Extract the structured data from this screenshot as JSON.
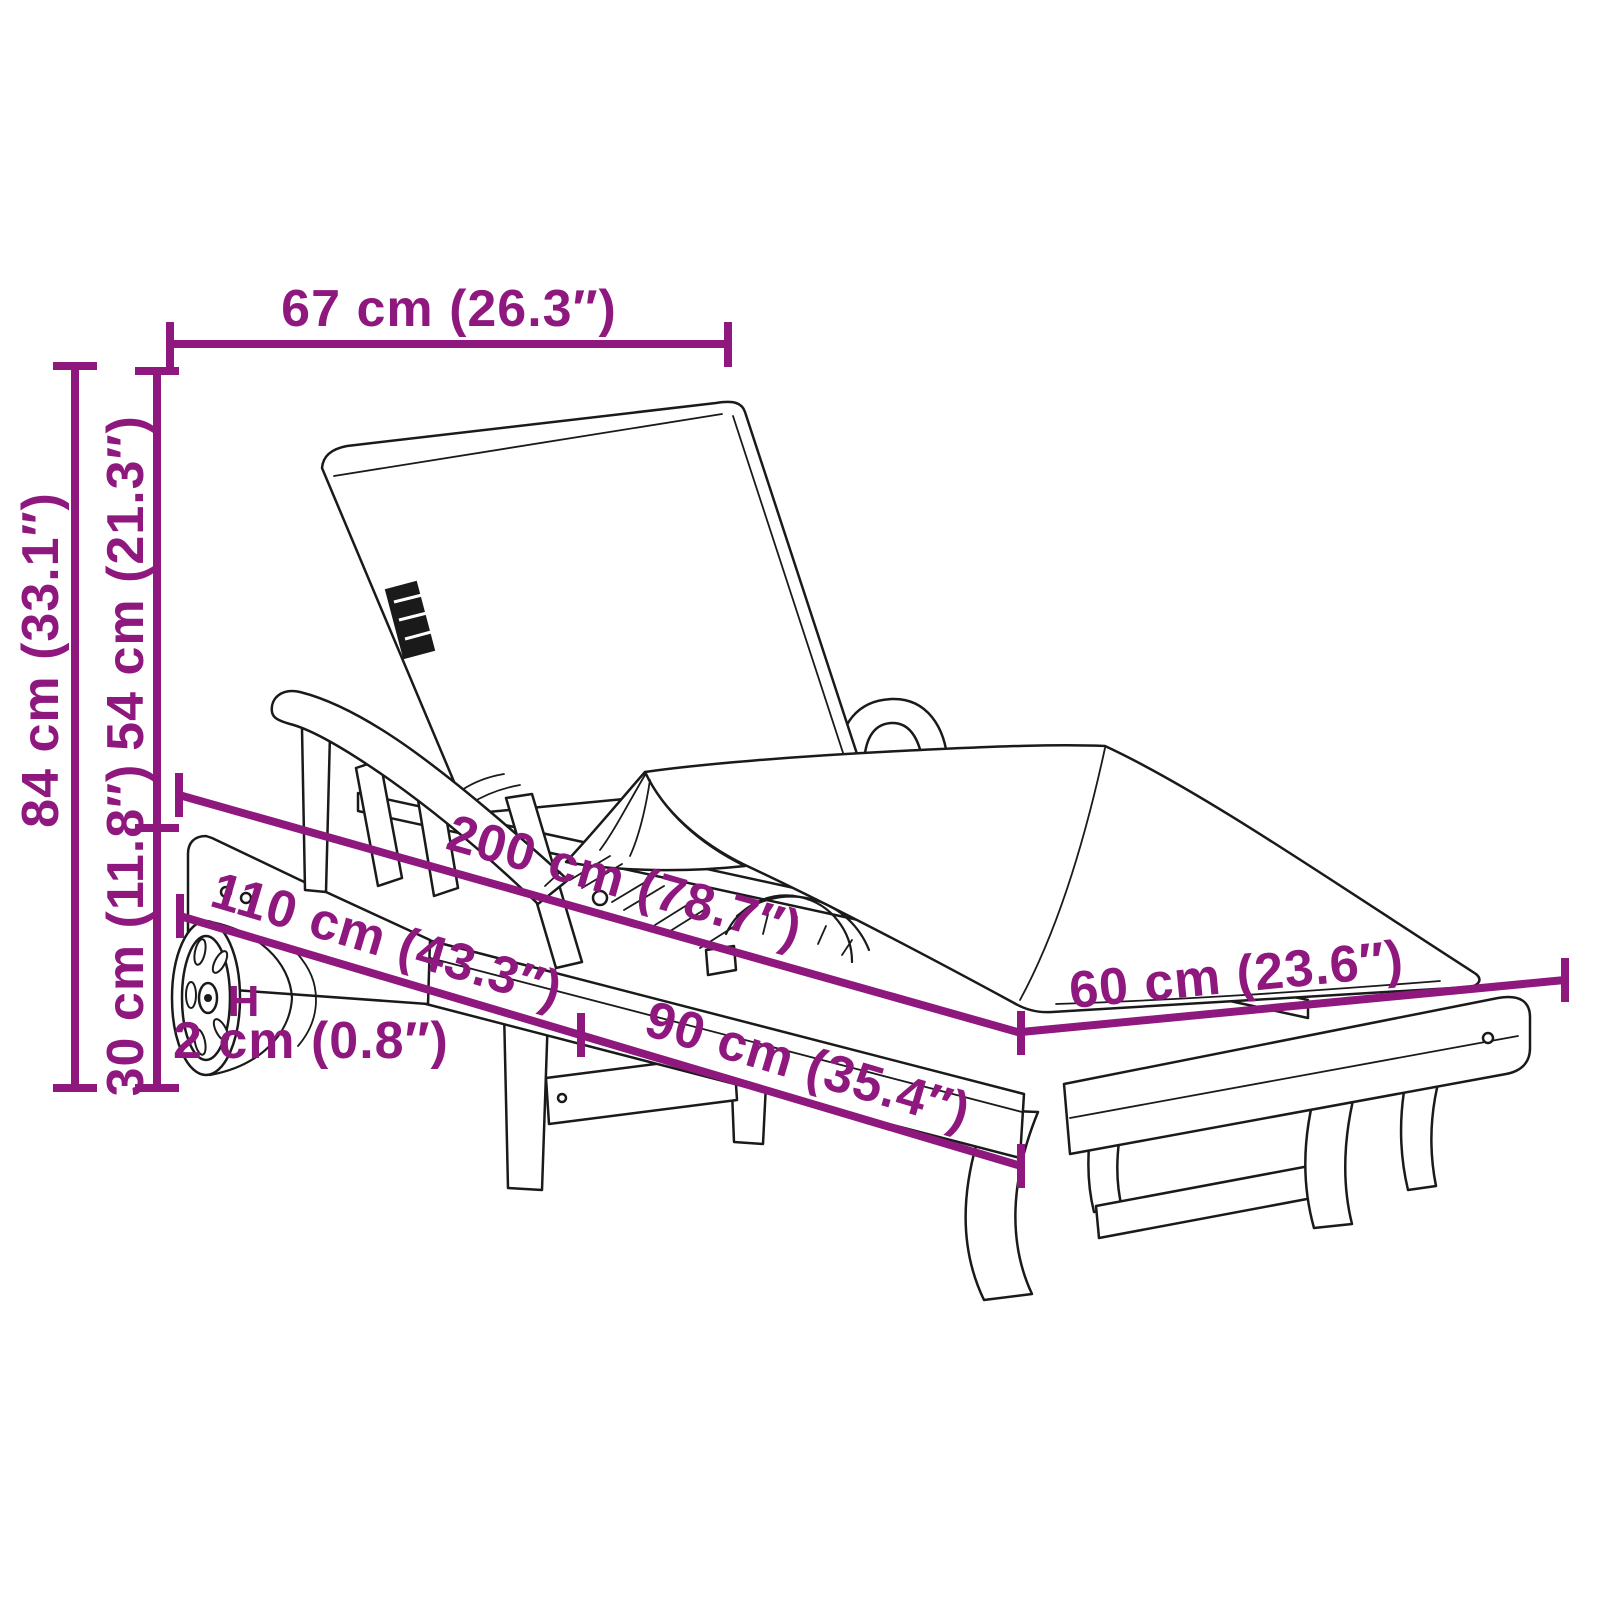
{
  "diagram": {
    "subject": "sun lounger with cushion, wheels and adjustable backrest — product dimension drawing",
    "accent_color": "#8E187E",
    "ink_color": "#1A1A1A",
    "background_color": "#FFFFFF"
  },
  "dimensions": {
    "top_width": {
      "label": "67 cm (26.3″)",
      "orientation": "horizontal"
    },
    "overall_height": {
      "label": "84 cm (33.1″)",
      "orientation": "vertical"
    },
    "backrest_height": {
      "label": "54 cm (21.3″)",
      "orientation": "vertical"
    },
    "seat_height": {
      "label": "30 cm (11.8″)",
      "orientation": "vertical"
    },
    "total_length": {
      "label": "200 cm (78.7″)",
      "orientation": "diagonal"
    },
    "front_section_length": {
      "label": "110 cm (43.3″)",
      "orientation": "diagonal"
    },
    "rear_section_length": {
      "label": "90 cm (35.4″)",
      "orientation": "diagonal"
    },
    "width": {
      "label": "60 cm (23.6″)",
      "orientation": "diagonal"
    },
    "clearance_symbol": "H",
    "wheel_clearance": {
      "label": "2 cm (0.8″)",
      "orientation": "horizontal"
    }
  }
}
